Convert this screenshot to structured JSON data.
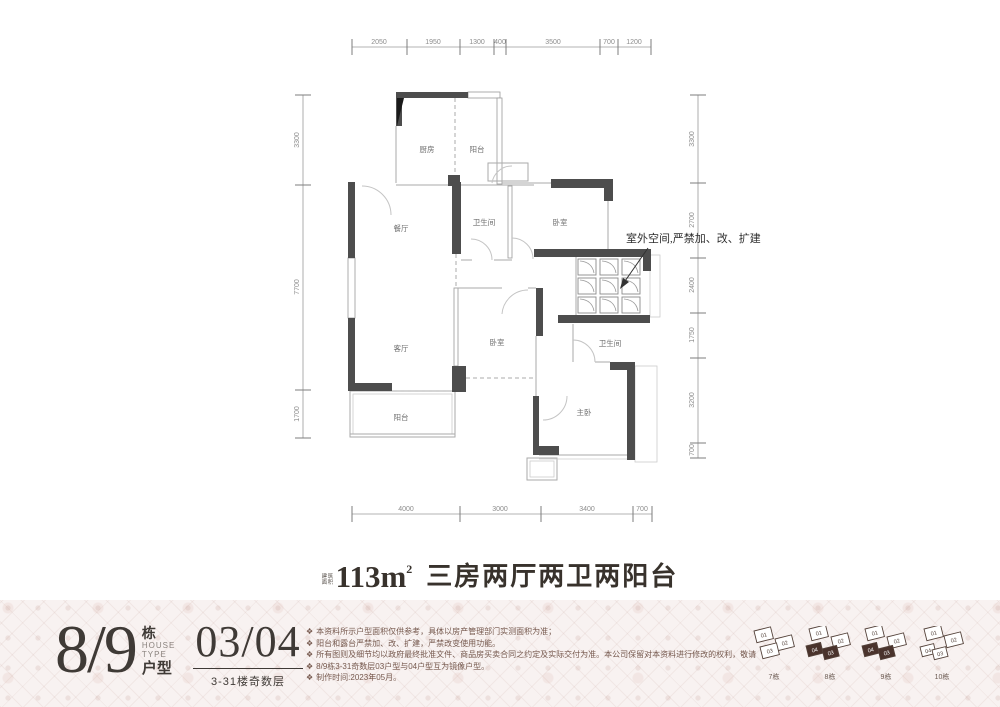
{
  "plan": {
    "dims_top": [
      "2050",
      "1950",
      "1300",
      "400",
      "3500",
      "700",
      "1200"
    ],
    "dims_left": [
      "3300",
      "7700",
      "1700"
    ],
    "dims_right": [
      "3300",
      "2700",
      "2400",
      "1750",
      "3200",
      "700"
    ],
    "dims_bottom": [
      "4000",
      "3000",
      "3400",
      "700"
    ],
    "rooms": {
      "kitchen": "厨房",
      "north_balcony": "阳台",
      "dining": "餐厅",
      "bath1": "卫生间",
      "bedroom1": "卧室",
      "living": "客厅",
      "bedroom2": "卧室",
      "bath2": "卫生间",
      "master": "主卧",
      "south_balcony": "阳台"
    },
    "annotation": "室外空间,严禁加、改、扩建",
    "wall_color": "#4d4d4d"
  },
  "caption": {
    "prefix": "建筑面积",
    "area": "113m",
    "sup": "2",
    "desc": "三房两厅两卫两阳台"
  },
  "footer": {
    "building_number": "8/9",
    "building_label": "栋",
    "house": "HOUSE",
    "type": "TYPE",
    "huxing": "户型",
    "unit_numbers": "03/04",
    "floors": "3-31楼奇数层",
    "bullet": "❖",
    "notes": [
      "本资料所示户型面积仅供参考，具体以房产管理部门实测面积为准；",
      "阳台和露台严禁加、改、扩建，严禁改变使用功能。",
      "所有图则及细节均以政府最终批准文件、商品房买卖合同之约定及实际交付为准。本公司保留对本资料进行修改的权利，敬请留意最新资料。",
      "8/9栋3-31奇数层03户型与04户型互为镜像户型。",
      "制作时间:2023年05月。"
    ],
    "buildings": [
      {
        "name": "7栋",
        "units": [
          {
            "label": "01"
          },
          {
            "label": "02"
          },
          {
            "label": "03"
          }
        ]
      },
      {
        "name": "8栋",
        "units": [
          {
            "label": "01"
          },
          {
            "label": "02"
          },
          {
            "label": "03"
          },
          {
            "label": "04"
          }
        ]
      },
      {
        "name": "9栋",
        "units": [
          {
            "label": "01"
          },
          {
            "label": "02"
          },
          {
            "label": "03"
          },
          {
            "label": "04"
          }
        ]
      },
      {
        "name": "10栋",
        "units": [
          {
            "label": "01"
          },
          {
            "label": "02"
          },
          {
            "label": "03"
          },
          {
            "label": "04"
          }
        ]
      }
    ],
    "accent_dark": "#4a332c"
  }
}
